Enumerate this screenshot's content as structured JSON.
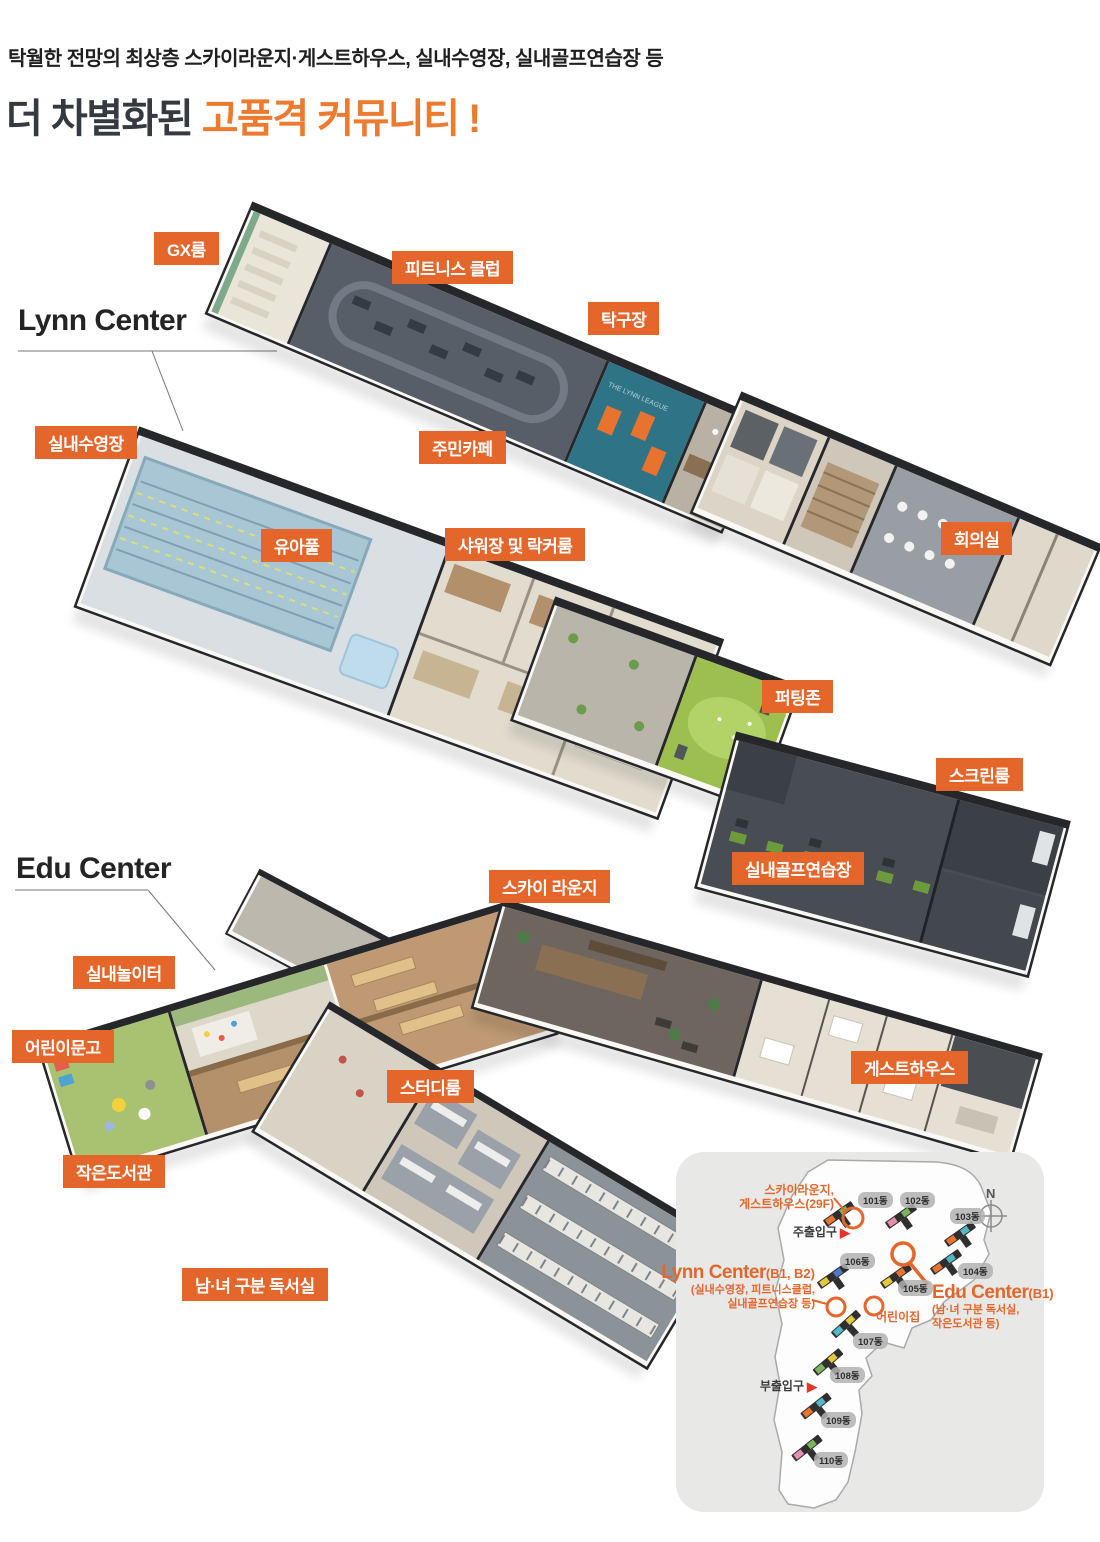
{
  "header": {
    "subtitle": "탁월한 전망의 최상층 스카이라운지·게스트하우스, 실내수영장, 실내골프연습장 등",
    "title_prefix": "더 차별화된 ",
    "title_accent": "고품격 커뮤니티 !"
  },
  "sections": {
    "lynn_title": "Lynn Center",
    "edu_title": "Edu Center"
  },
  "facility_labels": [
    "GX룸",
    "피트니스 클럽",
    "탁구장",
    "실내수영장",
    "주민카페",
    "유아풀",
    "샤워장 및 락커룸",
    "회의실",
    "퍼팅존",
    "스크린룸",
    "실내골프연습장",
    "스카이 라운지",
    "실내놀이터",
    "어린이문고",
    "스터디룸",
    "게스트하우스",
    "작은도서관",
    "남·녀 구분 독서실"
  ],
  "floor_texts": {
    "league": "THE LYNN LEAGUE"
  },
  "site_map": {
    "sky_note": [
      "스카이라운지,",
      "게스트하우스(29F)"
    ],
    "main_entrance": "주출입구",
    "sub_entrance": "부출입구",
    "daycare": "어린이집",
    "compass": "N",
    "lynn": {
      "name": "Lynn Center",
      "floors": "(B1, B2)",
      "desc": [
        "(실내수영장, 피트니스클럽,",
        "실내골프연습장 등)"
      ]
    },
    "edu": {
      "name": "Edu Center",
      "floors": "(B1)",
      "desc": [
        "(남·녀 구분 독서실,",
        "작은도서관 등)"
      ]
    },
    "buildings": [
      "101동",
      "102동",
      "103동",
      "104동",
      "105동",
      "106동",
      "107동",
      "108동",
      "109동",
      "110동"
    ]
  },
  "colors": {
    "accent_orange": "#E5662B",
    "title_orange": "#EC7A2F",
    "entrance_red": "#E8332A",
    "map_bg": "#E8E8E7"
  }
}
